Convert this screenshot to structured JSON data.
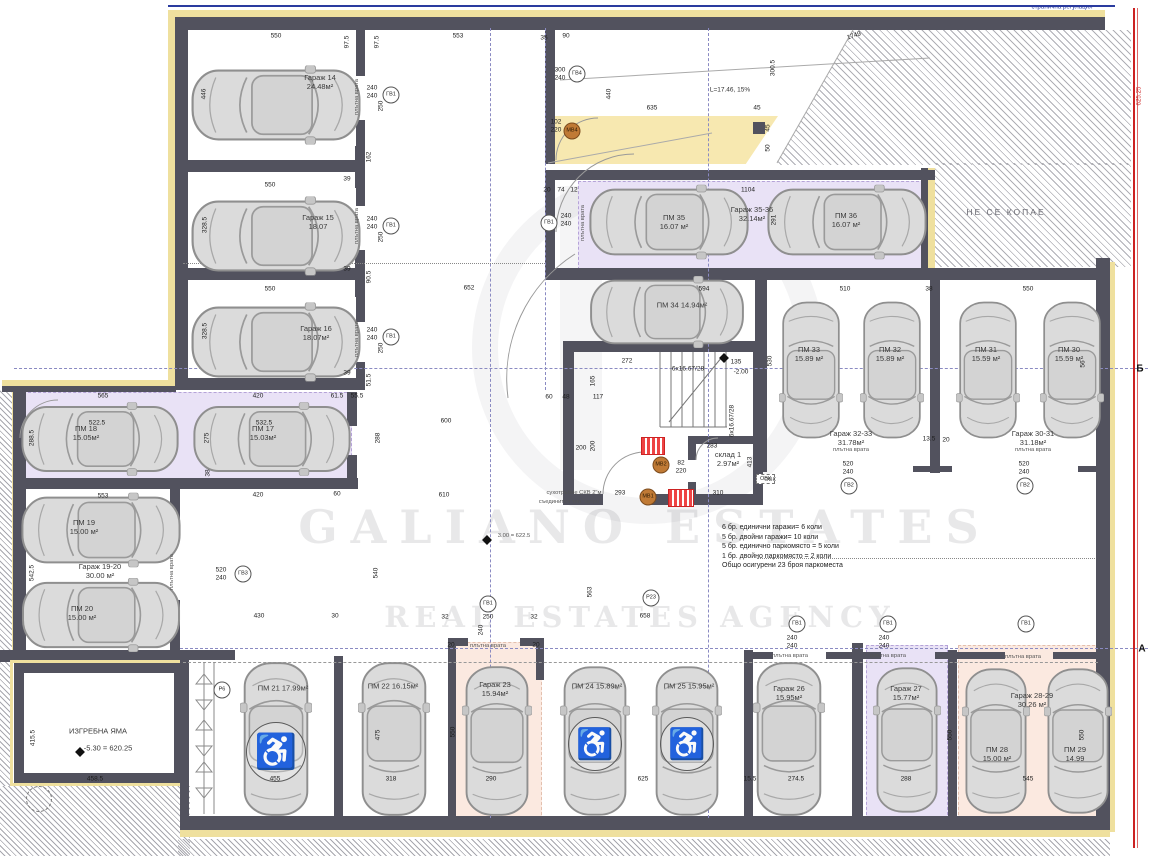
{
  "watermark": {
    "line1": "GALIANO  ESTATES",
    "line2": "REAL ESTATES AGENCY"
  },
  "boundary": {
    "top_label": "странична регулация",
    "no_dig": "НЕ СЕ КОПАЕ",
    "right_elevation": "625.25"
  },
  "axes": {
    "b_label": "Б",
    "a_label": "А"
  },
  "ramp": {
    "label": "L=17.46, 15%"
  },
  "summary": {
    "lines": [
      "6 бр. единични гаражи= 6 коли",
      "5 бр. двойни гаражи= 10 коли",
      "5 бр. единично паркомясто = 5 коли",
      "1 бр. двойно паркомясто = 2 коли",
      "Общо осигурени 23 броя паркоместа"
    ]
  },
  "spaces": [
    {
      "lines": [
        "Гараж 14",
        "24.48м²"
      ],
      "x": 320,
      "y": 82
    },
    {
      "lines": [
        "Гараж 15",
        "18.07"
      ],
      "x": 318,
      "y": 222
    },
    {
      "lines": [
        "Гараж 16",
        "18.07м²"
      ],
      "x": 316,
      "y": 333
    },
    {
      "lines": [
        "ПМ 18",
        "15.05м²"
      ],
      "x": 86,
      "y": 433
    },
    {
      "lines": [
        "ПМ 17",
        "15.03м²"
      ],
      "x": 263,
      "y": 433
    },
    {
      "lines": [
        "ПМ 19",
        "15.00 м²"
      ],
      "x": 84,
      "y": 527
    },
    {
      "lines": [
        "Гараж 19-20",
        "30.00 м²"
      ],
      "x": 100,
      "y": 571
    },
    {
      "lines": [
        "ПМ 20",
        "15.00 м²"
      ],
      "x": 82,
      "y": 613
    },
    {
      "lines": [
        "ПМ 35",
        "16.07 м²"
      ],
      "x": 674,
      "y": 222
    },
    {
      "lines": [
        "Гараж 35-36",
        "32.14м²"
      ],
      "x": 752,
      "y": 214
    },
    {
      "lines": [
        "ПМ 36",
        "16.07 м²"
      ],
      "x": 846,
      "y": 220
    },
    {
      "lines": [
        "ПМ 34  14.94м²"
      ],
      "x": 682,
      "y": 305
    },
    {
      "lines": [
        "ПМ 33",
        "15.89 м²"
      ],
      "x": 809,
      "y": 354
    },
    {
      "lines": [
        "ПМ 32",
        "15.89 м²"
      ],
      "x": 890,
      "y": 354
    },
    {
      "lines": [
        "Гараж 32-33",
        "31.78м²"
      ],
      "x": 851,
      "y": 438
    },
    {
      "lines": [
        "ПМ 31",
        "15.59 м²"
      ],
      "x": 986,
      "y": 354
    },
    {
      "lines": [
        "ПМ 30",
        "15.59 м²"
      ],
      "x": 1069,
      "y": 354
    },
    {
      "lines": [
        "Гараж 30-31",
        "31.18м²"
      ],
      "x": 1033,
      "y": 438
    },
    {
      "lines": [
        "ПМ 21  17.99м²"
      ],
      "x": 283,
      "y": 688
    },
    {
      "lines": [
        "ПМ 22  16.15м²"
      ],
      "x": 393,
      "y": 686
    },
    {
      "lines": [
        "Гараж 23",
        "15.94м²"
      ],
      "x": 495,
      "y": 689
    },
    {
      "lines": [
        "ПМ 24  15.89м²"
      ],
      "x": 597,
      "y": 686
    },
    {
      "lines": [
        "ПМ 25  15.95м²"
      ],
      "x": 689,
      "y": 686
    },
    {
      "lines": [
        "Гараж 26",
        "15.95м²"
      ],
      "x": 789,
      "y": 693
    },
    {
      "lines": [
        "Гараж 27",
        "15.77м²"
      ],
      "x": 906,
      "y": 693
    },
    {
      "lines": [
        "Гараж 28-29",
        "30.26 м²"
      ],
      "x": 1032,
      "y": 700
    },
    {
      "lines": [
        "ПМ 28",
        "15.00 м²"
      ],
      "x": 997,
      "y": 754
    },
    {
      "lines": [
        "ПМ 29",
        "14.99"
      ],
      "x": 1075,
      "y": 754
    },
    {
      "lines": [
        "склад 1",
        "2.97м²"
      ],
      "x": 728,
      "y": 459
    },
    {
      "lines": [
        "ИЗГРЕБНА ЯМА"
      ],
      "x": 98,
      "y": 731
    },
    {
      "lines": [
        "-5.30 = 620.25"
      ],
      "x": 108,
      "y": 748
    }
  ],
  "circles": [
    {
      "t": "ГВ1",
      "x": 391,
      "y": 95
    },
    {
      "t": "ГВ1",
      "x": 391,
      "y": 226
    },
    {
      "t": "ГВ1",
      "x": 391,
      "y": 337
    },
    {
      "t": "ГВ1",
      "x": 549,
      "y": 223
    },
    {
      "t": "ГВ1",
      "x": 488,
      "y": 604
    },
    {
      "t": "ГВ1",
      "x": 797,
      "y": 624
    },
    {
      "t": "ГВ1",
      "x": 888,
      "y": 624
    },
    {
      "t": "ГВ1",
      "x": 1026,
      "y": 624
    },
    {
      "t": "ГВ2",
      "x": 849,
      "y": 486
    },
    {
      "t": "ГВ2",
      "x": 1025,
      "y": 486
    },
    {
      "t": "ГВ3",
      "x": 243,
      "y": 574
    },
    {
      "t": "ГВ4",
      "x": 577,
      "y": 74
    },
    {
      "t": "Р6",
      "x": 222,
      "y": 690
    },
    {
      "t": "Р23",
      "x": 651,
      "y": 598
    },
    {
      "t": "МВ4",
      "x": 572,
      "y": 131,
      "o": 1
    },
    {
      "t": "МВ2",
      "x": 661,
      "y": 465,
      "o": 1
    },
    {
      "t": "МВ1",
      "x": 648,
      "y": 497,
      "o": 1
    }
  ],
  "notes": [
    {
      "t": "плътна врата",
      "x": 357,
      "y": 97,
      "r": -90,
      "c": "tiny"
    },
    {
      "t": "плътна врата",
      "x": 357,
      "y": 226,
      "r": -90,
      "c": "tiny"
    },
    {
      "t": "плътна врата",
      "x": 357,
      "y": 339,
      "r": -90,
      "c": "tiny"
    },
    {
      "t": "плътна врата",
      "x": 583,
      "y": 223,
      "r": -90,
      "c": "tiny"
    },
    {
      "t": "плътна врата",
      "x": 172,
      "y": 572,
      "r": -90,
      "c": "tiny"
    },
    {
      "t": "плътна врата",
      "x": 488,
      "y": 646,
      "c": "tiny"
    },
    {
      "t": "плътна врата",
      "x": 790,
      "y": 656,
      "c": "tiny"
    },
    {
      "t": "плътна врата",
      "x": 888,
      "y": 656,
      "c": "tiny"
    },
    {
      "t": "плътна врата",
      "x": 1023,
      "y": 657,
      "c": "tiny"
    },
    {
      "t": "плътна врата",
      "x": 851,
      "y": 450,
      "c": "tiny"
    },
    {
      "t": "плътна врата",
      "x": 1033,
      "y": 450,
      "c": "tiny"
    },
    {
      "t": "сухотръбие СКВ 2\"м",
      "x": 574,
      "y": 493,
      "c": "tiny"
    },
    {
      "t": "съединител тип \"щорц\"",
      "x": 570,
      "y": 502,
      "c": "tiny"
    },
    {
      "t": "L=17.46, 15%",
      "x": 730,
      "y": 90
    },
    {
      "t": "странична регулация",
      "x": 1062,
      "y": 7,
      "c": "blue"
    },
    {
      "t": "НЕ СЕ КОПАЕ",
      "x": 1006,
      "y": 212,
      "c": "nodig"
    },
    {
      "t": "3.00 = 622.5",
      "x": 514,
      "y": 536,
      "c": "tiny"
    },
    {
      "t": "625.25",
      "x": 1139,
      "y": 96,
      "r": -90,
      "c": "red"
    },
    {
      "t": "Б",
      "x": 1140,
      "y": 369,
      "c": "axis"
    },
    {
      "t": "А",
      "x": 1142,
      "y": 649,
      "c": "axis"
    },
    {
      "t": "ОВК",
      "x": 770,
      "y": 480,
      "c": "tiny"
    }
  ],
  "dims": [
    {
      "t": "550",
      "x": 276,
      "y": 36
    },
    {
      "t": "97.5",
      "x": 347,
      "y": 42,
      "r": -90
    },
    {
      "t": "97.5",
      "x": 377,
      "y": 42,
      "r": -90
    },
    {
      "t": "553",
      "x": 458,
      "y": 36
    },
    {
      "t": "35",
      "x": 544,
      "y": 38
    },
    {
      "t": "90",
      "x": 566,
      "y": 36
    },
    {
      "t": "300",
      "x": 560,
      "y": 70
    },
    {
      "t": "240",
      "x": 560,
      "y": 78
    },
    {
      "t": "440",
      "x": 609,
      "y": 94,
      "r": -90
    },
    {
      "t": "635",
      "x": 652,
      "y": 108
    },
    {
      "t": "45",
      "x": 757,
      "y": 108
    },
    {
      "t": "45",
      "x": 768,
      "y": 128,
      "r": -90
    },
    {
      "t": "50",
      "x": 768,
      "y": 148,
      "r": -90
    },
    {
      "t": "300.5",
      "x": 773,
      "y": 68,
      "r": -90
    },
    {
      "t": "1749",
      "x": 854,
      "y": 36,
      "r": -18
    },
    {
      "t": "102",
      "x": 556,
      "y": 122
    },
    {
      "t": "220",
      "x": 556,
      "y": 130
    },
    {
      "t": "20",
      "x": 547,
      "y": 190
    },
    {
      "t": "74",
      "x": 561,
      "y": 190
    },
    {
      "t": "12",
      "x": 574,
      "y": 190
    },
    {
      "t": "1104",
      "x": 748,
      "y": 190
    },
    {
      "t": "240",
      "x": 566,
      "y": 216
    },
    {
      "t": "240",
      "x": 566,
      "y": 224
    },
    {
      "t": "291",
      "x": 774,
      "y": 220,
      "r": -90
    },
    {
      "t": "594",
      "x": 704,
      "y": 289
    },
    {
      "t": "652",
      "x": 469,
      "y": 288
    },
    {
      "t": "510",
      "x": 845,
      "y": 289
    },
    {
      "t": "38",
      "x": 929,
      "y": 289
    },
    {
      "t": "550",
      "x": 1028,
      "y": 289
    },
    {
      "t": "550",
      "x": 270,
      "y": 185
    },
    {
      "t": "550",
      "x": 270,
      "y": 289
    },
    {
      "t": "446",
      "x": 204,
      "y": 94,
      "r": -90
    },
    {
      "t": "328.5",
      "x": 205,
      "y": 225,
      "r": -90
    },
    {
      "t": "328.5",
      "x": 205,
      "y": 331,
      "r": -90
    },
    {
      "t": "240",
      "x": 372,
      "y": 88
    },
    {
      "t": "240",
      "x": 372,
      "y": 96
    },
    {
      "t": "250",
      "x": 381,
      "y": 106,
      "r": -90
    },
    {
      "t": "240",
      "x": 372,
      "y": 219
    },
    {
      "t": "240",
      "x": 372,
      "y": 227
    },
    {
      "t": "250",
      "x": 381,
      "y": 237,
      "r": -90
    },
    {
      "t": "240",
      "x": 372,
      "y": 330
    },
    {
      "t": "240",
      "x": 372,
      "y": 338
    },
    {
      "t": "250",
      "x": 381,
      "y": 348,
      "r": -90
    },
    {
      "t": "162",
      "x": 369,
      "y": 157,
      "r": -90
    },
    {
      "t": "39",
      "x": 347,
      "y": 179
    },
    {
      "t": "90.5",
      "x": 369,
      "y": 277,
      "r": -90
    },
    {
      "t": "39",
      "x": 347,
      "y": 269
    },
    {
      "t": "51.5",
      "x": 369,
      "y": 380,
      "r": -90
    },
    {
      "t": "39",
      "x": 347,
      "y": 373
    },
    {
      "t": "565",
      "x": 103,
      "y": 396
    },
    {
      "t": "420",
      "x": 258,
      "y": 396
    },
    {
      "t": "61.5",
      "x": 337,
      "y": 396
    },
    {
      "t": "55.5",
      "x": 357,
      "y": 396
    },
    {
      "t": "522.5",
      "x": 97,
      "y": 423
    },
    {
      "t": "532.5",
      "x": 264,
      "y": 423
    },
    {
      "t": "288.5",
      "x": 32,
      "y": 438,
      "r": -90
    },
    {
      "t": "275",
      "x": 207,
      "y": 438,
      "r": -90
    },
    {
      "t": "288",
      "x": 378,
      "y": 438,
      "r": -90
    },
    {
      "t": "553",
      "x": 103,
      "y": 496
    },
    {
      "t": "420",
      "x": 258,
      "y": 495
    },
    {
      "t": "60",
      "x": 337,
      "y": 494
    },
    {
      "t": "38",
      "x": 208,
      "y": 473,
      "r": -90
    },
    {
      "t": "542.5",
      "x": 32,
      "y": 573,
      "r": -90
    },
    {
      "t": "520",
      "x": 221,
      "y": 570
    },
    {
      "t": "240",
      "x": 221,
      "y": 578
    },
    {
      "t": "600",
      "x": 446,
      "y": 421
    },
    {
      "t": "610",
      "x": 444,
      "y": 495
    },
    {
      "t": "293",
      "x": 620,
      "y": 493
    },
    {
      "t": "310",
      "x": 718,
      "y": 493
    },
    {
      "t": "283",
      "x": 712,
      "y": 446
    },
    {
      "t": "135",
      "x": 736,
      "y": 362
    },
    {
      "t": "-2.00",
      "x": 741,
      "y": 372
    },
    {
      "t": "272",
      "x": 627,
      "y": 361
    },
    {
      "t": "165",
      "x": 593,
      "y": 381,
      "r": -90
    },
    {
      "t": "117",
      "x": 598,
      "y": 397
    },
    {
      "t": "60",
      "x": 549,
      "y": 397
    },
    {
      "t": "48",
      "x": 566,
      "y": 397
    },
    {
      "t": "200",
      "x": 581,
      "y": 448
    },
    {
      "t": "200",
      "x": 593,
      "y": 446,
      "r": -90
    },
    {
      "t": "82",
      "x": 681,
      "y": 463
    },
    {
      "t": "220",
      "x": 681,
      "y": 471
    },
    {
      "t": "6x16.67/28",
      "x": 688,
      "y": 369
    },
    {
      "t": "6x16.67/28",
      "x": 732,
      "y": 421,
      "r": -90
    },
    {
      "t": "413",
      "x": 750,
      "y": 462,
      "r": -90
    },
    {
      "t": "530",
      "x": 770,
      "y": 361,
      "r": -90
    },
    {
      "t": "13.5",
      "x": 929,
      "y": 439
    },
    {
      "t": "20",
      "x": 946,
      "y": 440
    },
    {
      "t": "520",
      "x": 848,
      "y": 464
    },
    {
      "t": "240",
      "x": 848,
      "y": 472
    },
    {
      "t": "520",
      "x": 1024,
      "y": 464
    },
    {
      "t": "240",
      "x": 1024,
      "y": 472
    },
    {
      "t": "56",
      "x": 1083,
      "y": 364,
      "r": -90
    },
    {
      "t": "563",
      "x": 590,
      "y": 592,
      "r": -90
    },
    {
      "t": "658",
      "x": 645,
      "y": 616
    },
    {
      "t": "540",
      "x": 376,
      "y": 573,
      "r": -90
    },
    {
      "t": "430",
      "x": 259,
      "y": 616
    },
    {
      "t": "30",
      "x": 335,
      "y": 616
    },
    {
      "t": "250",
      "x": 488,
      "y": 617
    },
    {
      "t": "32",
      "x": 445,
      "y": 617
    },
    {
      "t": "32",
      "x": 534,
      "y": 617
    },
    {
      "t": "240",
      "x": 481,
      "y": 630,
      "r": -90
    },
    {
      "t": "455",
      "x": 275,
      "y": 779
    },
    {
      "t": "475",
      "x": 378,
      "y": 735,
      "r": -90
    },
    {
      "t": "318",
      "x": 391,
      "y": 779
    },
    {
      "t": "550",
      "x": 453,
      "y": 732,
      "r": -90
    },
    {
      "t": "290",
      "x": 491,
      "y": 779
    },
    {
      "t": "625",
      "x": 643,
      "y": 779
    },
    {
      "t": "15.5",
      "x": 750,
      "y": 779
    },
    {
      "t": "274.5",
      "x": 796,
      "y": 779
    },
    {
      "t": "288",
      "x": 906,
      "y": 779
    },
    {
      "t": "545",
      "x": 1028,
      "y": 779
    },
    {
      "t": "550",
      "x": 950,
      "y": 735,
      "r": -90
    },
    {
      "t": "550",
      "x": 1082,
      "y": 735,
      "r": -90
    },
    {
      "t": "240",
      "x": 792,
      "y": 638
    },
    {
      "t": "240",
      "x": 792,
      "y": 646
    },
    {
      "t": "240",
      "x": 884,
      "y": 638
    },
    {
      "t": "240",
      "x": 884,
      "y": 646
    },
    {
      "t": "20",
      "x": 451,
      "y": 645
    },
    {
      "t": "20",
      "x": 536,
      "y": 645
    },
    {
      "t": "458.5",
      "x": 95,
      "y": 779
    },
    {
      "t": "415.5",
      "x": 33,
      "y": 738,
      "r": -90
    }
  ]
}
